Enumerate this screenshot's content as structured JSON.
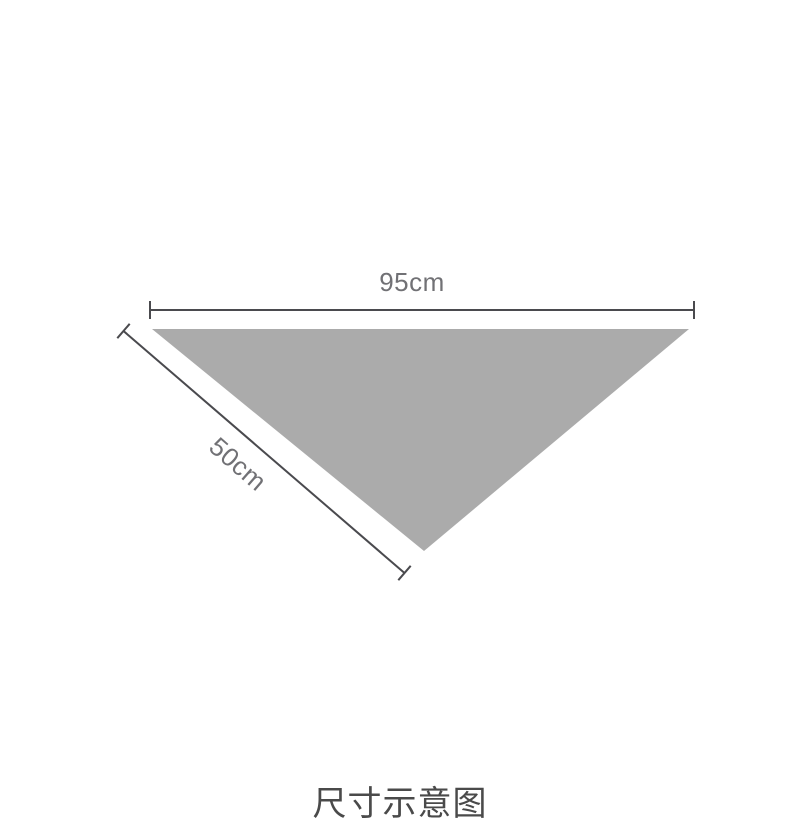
{
  "diagram": {
    "type": "product-dimension-diagram",
    "shape": "inverted-triangle",
    "top_width_label": "95cm",
    "side_length_label": "50cm",
    "caption": "尺寸示意图"
  },
  "colors": {
    "background": "#ffffff",
    "triangle_fill": "#ababab",
    "dimension_line": "#4a4a4e",
    "label_text": "#717175",
    "caption_text": "#4a4a4a"
  }
}
